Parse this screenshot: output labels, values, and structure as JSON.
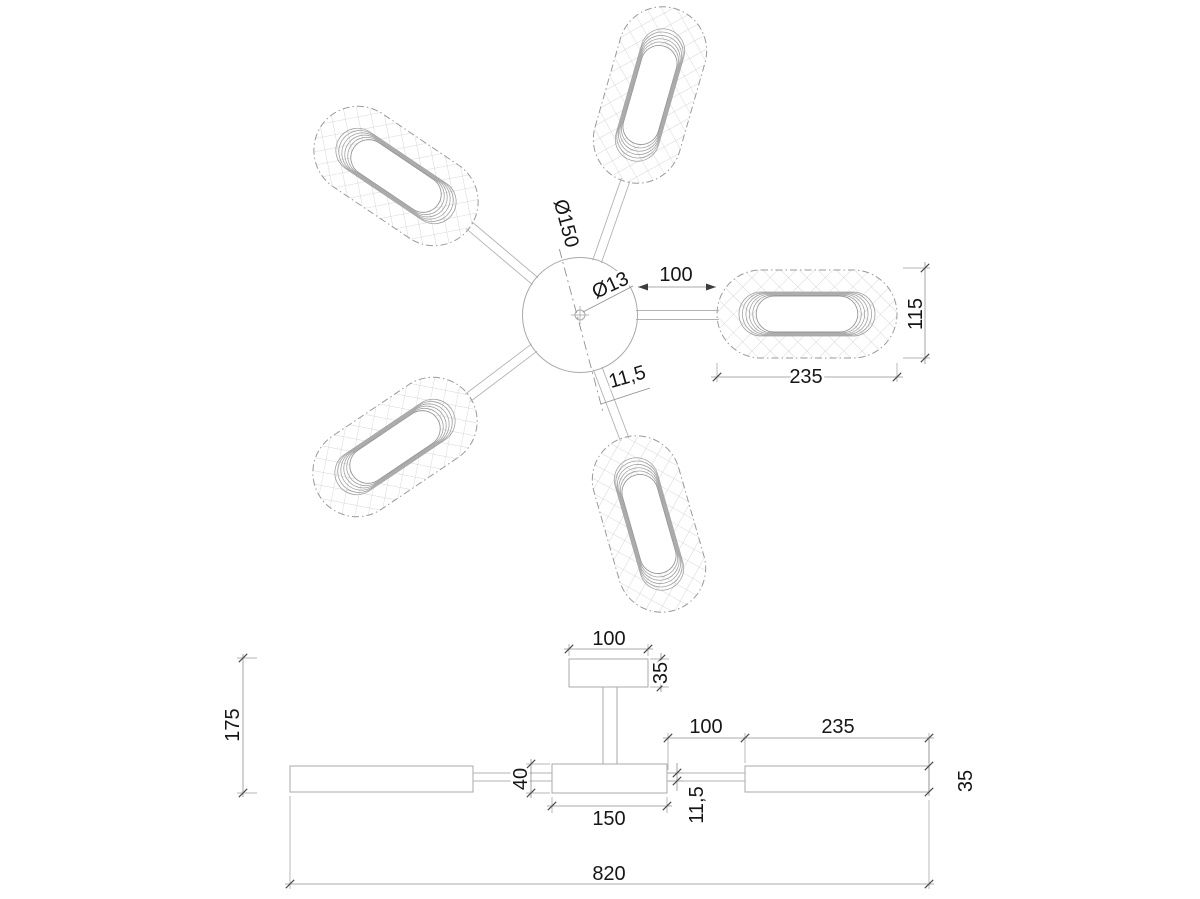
{
  "drawing": {
    "kind": "ceiling-lamp-5-arm-technical-drawing",
    "background": "#ffffff",
    "line_color": "#a9a9a9",
    "dim_color": "#8f8f8f",
    "text_color": "#161616"
  },
  "top_view": {
    "hub_diameter": "Ø150",
    "center_hole_diameter": "Ø13",
    "arm_gap": "100",
    "head_length": "235",
    "head_width": "115",
    "arm_tube_width": "11,5"
  },
  "side_view": {
    "canopy_width": "100",
    "canopy_height": "35",
    "drop_height": "175",
    "disc_thickness": "40",
    "disc_diameter": "150",
    "arm_tube_height": "11,5",
    "arm_gap": "100",
    "head_length": "235",
    "head_thickness": "35",
    "overall_width": "820"
  }
}
